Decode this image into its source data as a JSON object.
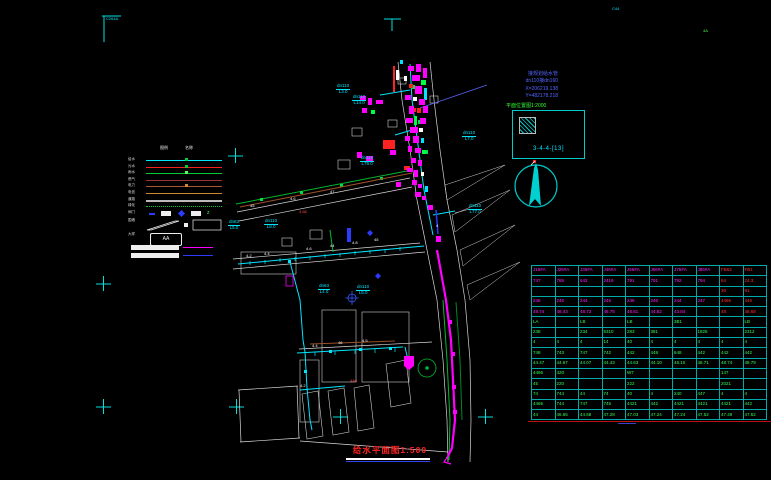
{
  "palette": {
    "background": "#000000",
    "cyan": "#00e5ff",
    "magenta": "#ff00ff",
    "green": "#00cc33",
    "red": "#ff2222",
    "blue": "#5566ff",
    "white": "#ffffff",
    "brown": "#9b4f2a",
    "orange": "#cc8833",
    "gray": "#aaaaaa",
    "table_border": "#cc2222"
  },
  "drawing": {
    "title": "给水平面图1:500",
    "detail_box": {
      "title": "平面位置图1:2000",
      "label": "3-4-4-[13]"
    },
    "annotation": {
      "line1": "接规划给水管",
      "line2": "dn110接dn160",
      "line3": "X=206219.138",
      "line4": "Y=482178.218"
    },
    "labels": [
      {
        "x": 336,
        "y": 84,
        "l1": "dn110",
        "l2": "L3.0"
      },
      {
        "x": 352,
        "y": 95,
        "l1": "dn110",
        "l2": "L14.0"
      },
      {
        "x": 462,
        "y": 131,
        "l1": "dn110",
        "l2": "L7.0"
      },
      {
        "x": 360,
        "y": 156,
        "l1": "dn110",
        "l2": "L79.0"
      },
      {
        "x": 468,
        "y": 204,
        "l1": "dn110",
        "l2": "L77.0"
      },
      {
        "x": 228,
        "y": 220,
        "l1": "dn63",
        "l2": "L5.0"
      },
      {
        "x": 264,
        "y": 219,
        "l1": "dn110",
        "l2": "L8.0"
      },
      {
        "x": 318,
        "y": 284,
        "l1": "dn63",
        "l2": "L4.0"
      },
      {
        "x": 356,
        "y": 285,
        "l1": "dn110",
        "l2": "L5.0"
      }
    ],
    "micro": [
      {
        "x": 246,
        "y": 254,
        "c": "#ffffff",
        "t": "4.2"
      },
      {
        "x": 264,
        "y": 252,
        "c": "#ffffff",
        "t": "4.4"
      },
      {
        "x": 306,
        "y": 247,
        "c": "#ffffff",
        "t": "4.6"
      },
      {
        "x": 330,
        "y": 244,
        "c": "#ffffff",
        "t": "44"
      },
      {
        "x": 352,
        "y": 241,
        "c": "#ffffff",
        "t": "4.8"
      },
      {
        "x": 374,
        "y": 238,
        "c": "#ffffff",
        "t": "45"
      },
      {
        "x": 312,
        "y": 344,
        "c": "#ffffff",
        "t": "4.4"
      },
      {
        "x": 338,
        "y": 341,
        "c": "#ffffff",
        "t": "46"
      },
      {
        "x": 362,
        "y": 339,
        "c": "#ffffff",
        "t": "4.5"
      },
      {
        "x": 300,
        "y": 384,
        "c": "#ffffff",
        "t": "4.2"
      },
      {
        "x": 250,
        "y": 204,
        "c": "#ffffff",
        "t": "45"
      },
      {
        "x": 290,
        "y": 197,
        "c": "#ffffff",
        "t": "4.6"
      },
      {
        "x": 330,
        "y": 190,
        "c": "#ffffff",
        "t": "47"
      },
      {
        "x": 299,
        "y": 210,
        "c": "#ff4444",
        "t": "4.66"
      },
      {
        "x": 350,
        "y": 379,
        "c": "#ff4444",
        "t": "4A6"
      },
      {
        "x": 436,
        "y": 224,
        "c": "#ffffff",
        "t": "4"
      },
      {
        "x": 106,
        "y": 17,
        "c": "#00e5ff",
        "t": "C264A"
      },
      {
        "x": 612,
        "y": 7,
        "c": "#00e5ff",
        "t": "C44"
      },
      {
        "x": 703,
        "y": 29,
        "c": "#44ff44",
        "t": "4A"
      }
    ]
  },
  "legend": {
    "headers": [
      "图例",
      "名称"
    ],
    "rows": [
      {
        "label": "给水",
        "type": "line",
        "color": "#00e5ff",
        "mark": "#00cc33"
      },
      {
        "label": "污水",
        "type": "line",
        "color": "#ee2222",
        "mark": "#00cc33"
      },
      {
        "label": "雨水",
        "type": "line",
        "color": "#00cc33",
        "mark": "#55ff55"
      },
      {
        "label": "燃气",
        "type": "line",
        "color": "#993333",
        "mark": ""
      },
      {
        "label": "电力",
        "type": "line",
        "color": "#aa5533",
        "mark": "#cc8833"
      },
      {
        "label": "电信",
        "type": "line",
        "color": "#cc8833",
        "mark": ""
      },
      {
        "label": "道路",
        "type": "thick",
        "color": "#bbbbbb",
        "mark": ""
      },
      {
        "label": "绿化",
        "type": "dotted",
        "color": "#00cc33",
        "mark": ""
      }
    ],
    "symbols_label": "阀门",
    "para_label": "围墙",
    "aa_label": "大样",
    "aa_text": "AA"
  },
  "table": {
    "columns": 10,
    "groups": [
      {
        "color": "#ff22ff",
        "red_cols": [
          8,
          9
        ],
        "red_color": "#ff3333",
        "rows": [
          [
            "J16#A",
            "J26#A",
            "J36#A",
            "J46#A",
            "J56#A",
            "J66#A",
            "J76#A",
            "J86#A",
            "FB62",
            "FB1"
          ],
          [
            "747",
            "765",
            "642",
            "2419",
            "791",
            "791",
            "792",
            "794",
            "64",
            "24.3"
          ],
          [
            "",
            "",
            "",
            "",
            "",
            "",
            "",
            "",
            "36",
            "81"
          ],
          [
            "246",
            "246",
            "244",
            "246",
            "246",
            "246",
            "244",
            "247",
            "4466",
            "446"
          ],
          [
            "48.74",
            "48.43",
            "48.73",
            "48.76",
            "48.81",
            "44.82",
            "43.84",
            "",
            "48",
            "48.68"
          ]
        ]
      },
      {
        "color": "#33ff55",
        "red_cols": [],
        "red_color": "",
        "rows": [
          [
            "LA",
            "",
            "LB",
            "",
            "LB",
            "",
            "3B1",
            "",
            "",
            "LB"
          ],
          [
            "238",
            "",
            "234",
            "5310",
            "283",
            "381",
            "",
            "1825",
            "",
            "2312"
          ],
          [
            "4",
            "4",
            "4",
            "14",
            "40",
            "4",
            "4",
            "4",
            "4",
            "4"
          ],
          [
            "748",
            "743",
            "747",
            "742",
            "442",
            "448",
            "648",
            "442",
            "442",
            "442"
          ],
          [
            "44.47",
            "44.67",
            "44.07",
            "44.43",
            "44.63",
            "44.10",
            "48.10",
            "48.71",
            "48.74",
            "48.79"
          ]
        ]
      },
      {
        "color": "#33ff55",
        "red_cols": [],
        "red_color": "",
        "rows": [
          [
            "4466",
            "420",
            "",
            "",
            "W7",
            "",
            "",
            "",
            "147",
            ""
          ],
          [
            "45",
            "220",
            "",
            "",
            "222",
            "",
            "",
            "",
            "2021",
            ""
          ],
          [
            "74",
            "744",
            "44",
            "74",
            "40",
            "4",
            "240",
            "447",
            "4",
            "4"
          ],
          [
            "4465",
            "744",
            "747",
            "745",
            "4421",
            "442",
            "4421",
            "4421",
            "4421",
            "442"
          ],
          [
            "44",
            "46.65",
            "44.68",
            "47.28",
            "47.03",
            "47.24",
            "47.24",
            "47.52",
            "47.49",
            "47.52"
          ]
        ]
      }
    ]
  }
}
